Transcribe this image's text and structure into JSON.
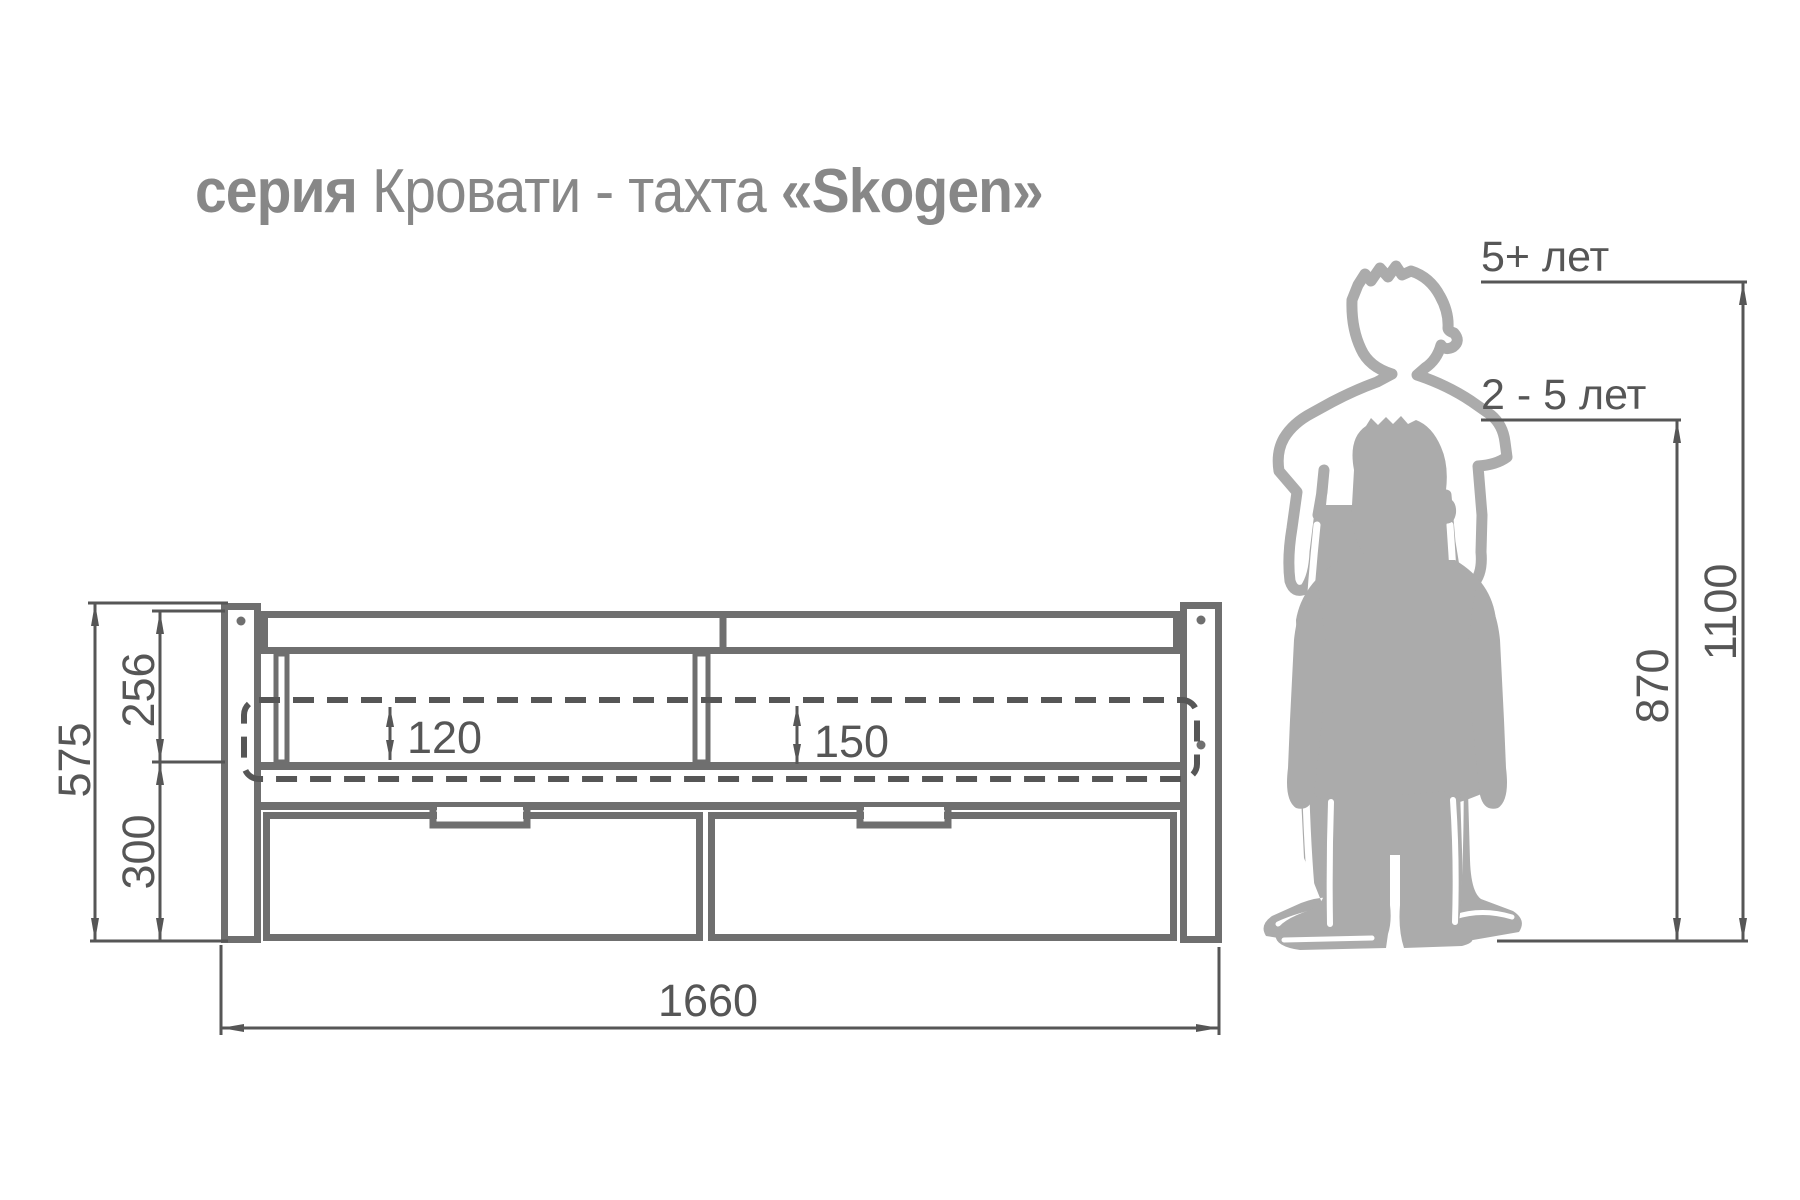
{
  "title": {
    "series_word": "серия",
    "product_type": " Кровати - тахта ",
    "series_name": "«Skogen»"
  },
  "bed": {
    "length_mm": "1660",
    "total_height_mm": "575",
    "backrest_height_mm": "256",
    "drawer_height_mm": "300",
    "mattress_drop_left_mm": "120",
    "mattress_drop_right_mm": "150"
  },
  "age_guide": {
    "older_label": "5+ лет",
    "older_height_mm": "1100",
    "younger_label": "2 - 5 лет",
    "younger_height_mm": "870"
  },
  "colors": {
    "outline": "#6f6f6f",
    "dimension": "#565656",
    "text": "#565656",
    "title_text": "#878787",
    "silhouette": "#ababab"
  }
}
